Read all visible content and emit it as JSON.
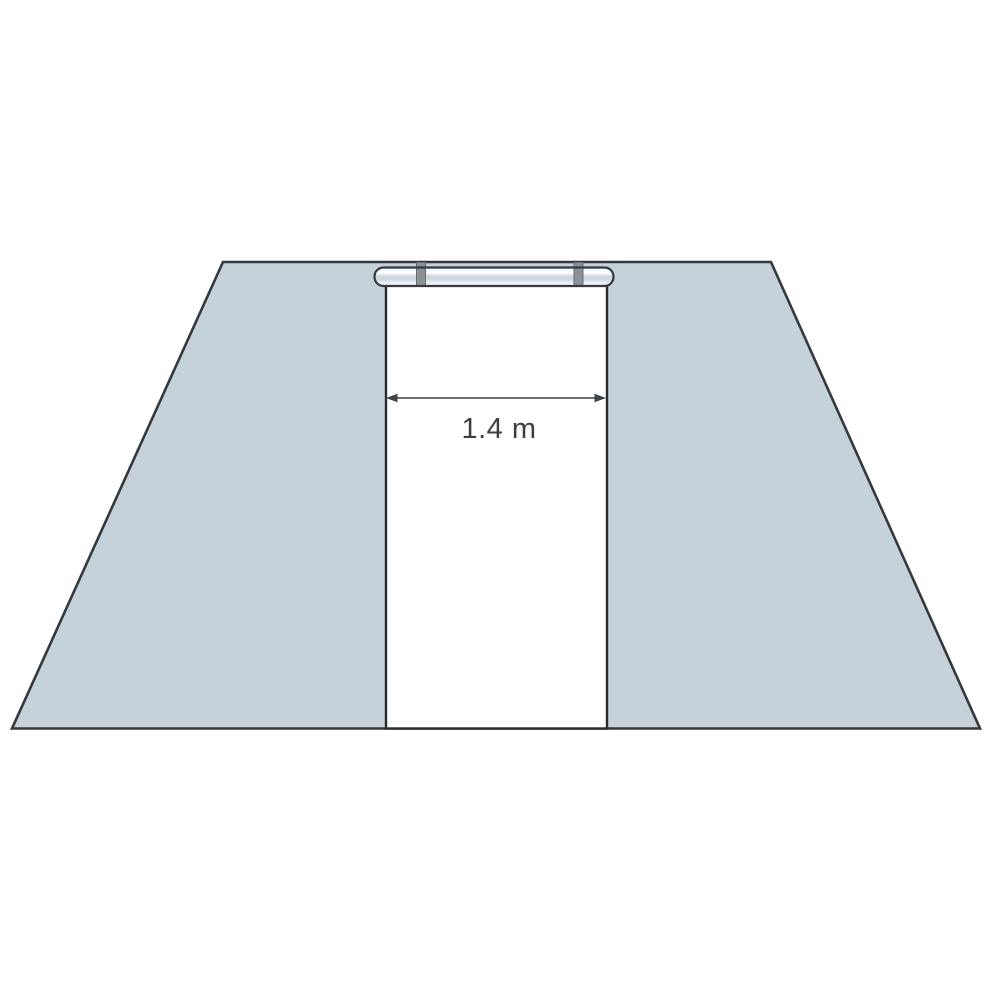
{
  "diagram": {
    "description": "Front elevation of a trapezoidal wall with a central rectangular door opening; a sliding-door rail with two hangers sits above the opening",
    "dimension": {
      "label": "1.4 m"
    }
  },
  "icons": {
    "rail": "sliding-door-rail",
    "hangers": "rail-hanger-brackets",
    "arrow": "double-headed-width-arrow"
  },
  "colors": {
    "background": "#ffffff",
    "wall_fill": "#c6d2da",
    "outline": "#34393e",
    "door_fill": "#ffffff",
    "rail_top": "#edf2f5",
    "rail_white": "#ffffff",
    "rail_band": "#ccd7de",
    "rail_bottom": "#eef3f6",
    "hanger_fill": "#8a9197",
    "arrow_color": "#3c4146",
    "label_color": "#3a3f44"
  }
}
